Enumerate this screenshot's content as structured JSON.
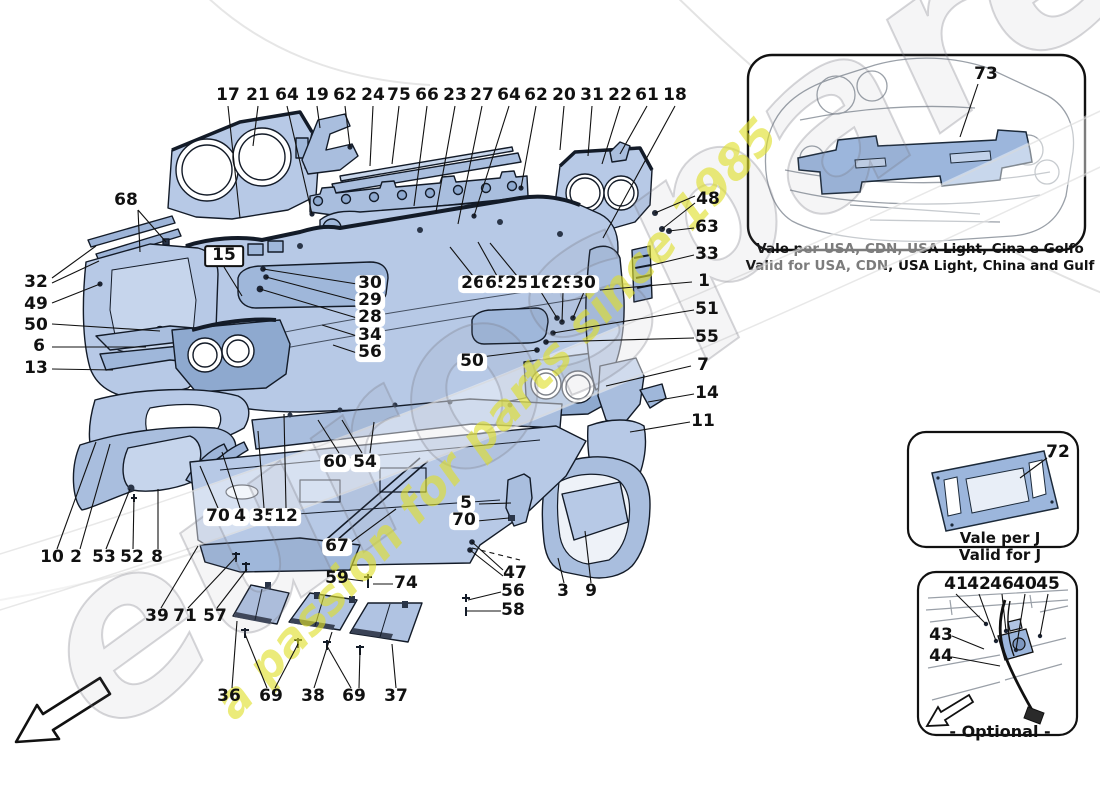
{
  "watermark": {
    "brand": "eurospares",
    "tagline": "a passion for parts since 1985"
  },
  "insets": {
    "usa": {
      "part_label": "73",
      "caption_line1": "Vale per USA, CDN, USA Light, Cina e Golfo",
      "caption_line2": "Valid for USA, CDN, USA Light, China and Gulf"
    },
    "japan": {
      "part_label": "72",
      "caption_line1": "Vale per J",
      "caption_line2": "Valid for J"
    },
    "optional": {
      "caption": "- Optional -"
    }
  },
  "callouts": [
    {
      "t": "17",
      "x": 228,
      "y": 96
    },
    {
      "t": "21",
      "x": 258,
      "y": 96
    },
    {
      "t": "64",
      "x": 287,
      "y": 96
    },
    {
      "t": "19",
      "x": 317,
      "y": 96
    },
    {
      "t": "62",
      "x": 345,
      "y": 96
    },
    {
      "t": "24",
      "x": 373,
      "y": 96
    },
    {
      "t": "75",
      "x": 399,
      "y": 96
    },
    {
      "t": "66",
      "x": 427,
      "y": 96
    },
    {
      "t": "23",
      "x": 455,
      "y": 96
    },
    {
      "t": "27",
      "x": 482,
      "y": 96
    },
    {
      "t": "64",
      "x": 509,
      "y": 96
    },
    {
      "t": "62",
      "x": 536,
      "y": 96
    },
    {
      "t": "20",
      "x": 564,
      "y": 96
    },
    {
      "t": "31",
      "x": 592,
      "y": 96
    },
    {
      "t": "22",
      "x": 620,
      "y": 96
    },
    {
      "t": "61",
      "x": 647,
      "y": 96
    },
    {
      "t": "18",
      "x": 675,
      "y": 96
    },
    {
      "t": "68",
      "x": 126,
      "y": 201
    },
    {
      "t": "32",
      "x": 36,
      "y": 283
    },
    {
      "t": "49",
      "x": 36,
      "y": 305
    },
    {
      "t": "50",
      "x": 36,
      "y": 326
    },
    {
      "t": "6",
      "x": 39,
      "y": 347
    },
    {
      "t": "13",
      "x": 36,
      "y": 369
    },
    {
      "t": "15",
      "x": 224,
      "y": 256,
      "s": 2
    },
    {
      "t": "30",
      "x": 370,
      "y": 284,
      "s": 1
    },
    {
      "t": "29",
      "x": 370,
      "y": 301,
      "s": 1
    },
    {
      "t": "28",
      "x": 370,
      "y": 318,
      "s": 1
    },
    {
      "t": "34",
      "x": 370,
      "y": 336,
      "s": 1
    },
    {
      "t": "56",
      "x": 370,
      "y": 353,
      "s": 1
    },
    {
      "t": "26",
      "x": 473,
      "y": 284,
      "s": 1
    },
    {
      "t": "65",
      "x": 497,
      "y": 284,
      "s": 1
    },
    {
      "t": "25",
      "x": 517,
      "y": 284,
      "s": 1
    },
    {
      "t": "16",
      "x": 541,
      "y": 284,
      "s": 1
    },
    {
      "t": "29",
      "x": 563,
      "y": 284,
      "s": 1
    },
    {
      "t": "30",
      "x": 584,
      "y": 284,
      "s": 1
    },
    {
      "t": "50",
      "x": 472,
      "y": 362,
      "s": 1
    },
    {
      "t": "48",
      "x": 708,
      "y": 200
    },
    {
      "t": "63",
      "x": 707,
      "y": 228
    },
    {
      "t": "33",
      "x": 707,
      "y": 255
    },
    {
      "t": "1",
      "x": 704,
      "y": 282
    },
    {
      "t": "51",
      "x": 707,
      "y": 310
    },
    {
      "t": "55",
      "x": 707,
      "y": 338
    },
    {
      "t": "7",
      "x": 703,
      "y": 366
    },
    {
      "t": "14",
      "x": 707,
      "y": 394
    },
    {
      "t": "11",
      "x": 703,
      "y": 422
    },
    {
      "t": "10",
      "x": 52,
      "y": 558
    },
    {
      "t": "2",
      "x": 76,
      "y": 558
    },
    {
      "t": "53",
      "x": 104,
      "y": 558
    },
    {
      "t": "52",
      "x": 132,
      "y": 558
    },
    {
      "t": "8",
      "x": 157,
      "y": 558
    },
    {
      "t": "39",
      "x": 157,
      "y": 617
    },
    {
      "t": "71",
      "x": 185,
      "y": 617
    },
    {
      "t": "57",
      "x": 215,
      "y": 617
    },
    {
      "t": "36",
      "x": 229,
      "y": 697
    },
    {
      "t": "69",
      "x": 271,
      "y": 697
    },
    {
      "t": "38",
      "x": 313,
      "y": 697
    },
    {
      "t": "69",
      "x": 354,
      "y": 697
    },
    {
      "t": "37",
      "x": 396,
      "y": 697
    },
    {
      "t": "60",
      "x": 335,
      "y": 463,
      "s": 1
    },
    {
      "t": "54",
      "x": 365,
      "y": 463,
      "s": 1
    },
    {
      "t": "70",
      "x": 218,
      "y": 517,
      "s": 1
    },
    {
      "t": "4",
      "x": 240,
      "y": 517,
      "s": 1
    },
    {
      "t": "35",
      "x": 264,
      "y": 517,
      "s": 1
    },
    {
      "t": "12",
      "x": 286,
      "y": 517,
      "s": 1
    },
    {
      "t": "67",
      "x": 337,
      "y": 547,
      "s": 1
    },
    {
      "t": "59",
      "x": 337,
      "y": 579
    },
    {
      "t": "74",
      "x": 406,
      "y": 584
    },
    {
      "t": "5",
      "x": 466,
      "y": 504,
      "s": 1
    },
    {
      "t": "70",
      "x": 464,
      "y": 521,
      "s": 1
    },
    {
      "t": "47",
      "x": 515,
      "y": 574
    },
    {
      "t": "56",
      "x": 513,
      "y": 592
    },
    {
      "t": "58",
      "x": 513,
      "y": 611
    },
    {
      "t": "3",
      "x": 563,
      "y": 592
    },
    {
      "t": "9",
      "x": 591,
      "y": 592
    },
    {
      "t": "73",
      "x": 986,
      "y": 75
    },
    {
      "t": "72",
      "x": 1058,
      "y": 453
    },
    {
      "t": "41",
      "x": 956,
      "y": 585
    },
    {
      "t": "42",
      "x": 979,
      "y": 585
    },
    {
      "t": "46",
      "x": 1002,
      "y": 585
    },
    {
      "t": "40",
      "x": 1025,
      "y": 585
    },
    {
      "t": "45",
      "x": 1048,
      "y": 585
    },
    {
      "t": "43",
      "x": 941,
      "y": 636
    },
    {
      "t": "44",
      "x": 941,
      "y": 657
    }
  ],
  "leaders": [
    [
      228,
      106,
      240,
      218
    ],
    [
      258,
      106,
      253,
      146
    ],
    [
      287,
      106,
      312,
      214
    ],
    [
      317,
      106,
      320,
      128
    ],
    [
      345,
      106,
      350,
      147
    ],
    [
      373,
      106,
      370,
      166
    ],
    [
      399,
      106,
      392,
      164
    ],
    [
      427,
      106,
      414,
      206
    ],
    [
      455,
      106,
      436,
      212
    ],
    [
      482,
      106,
      458,
      224
    ],
    [
      509,
      106,
      474,
      216
    ],
    [
      536,
      106,
      521,
      188
    ],
    [
      564,
      106,
      560,
      150
    ],
    [
      592,
      106,
      588,
      156
    ],
    [
      620,
      106,
      602,
      164
    ],
    [
      647,
      106,
      620,
      154
    ],
    [
      675,
      106,
      603,
      238
    ],
    [
      138,
      210,
      140,
      252
    ],
    [
      138,
      210,
      166,
      242
    ],
    [
      52,
      278,
      96,
      246
    ],
    [
      52,
      283,
      99,
      261
    ],
    [
      52,
      303,
      100,
      284
    ],
    [
      52,
      324,
      160,
      331
    ],
    [
      52,
      347,
      146,
      347
    ],
    [
      52,
      369,
      113,
      370
    ],
    [
      224,
      267,
      242,
      296
    ],
    [
      357,
      284,
      263,
      269
    ],
    [
      357,
      301,
      266,
      277
    ],
    [
      357,
      318,
      260,
      289
    ],
    [
      357,
      336,
      322,
      325
    ],
    [
      357,
      353,
      333,
      345
    ],
    [
      473,
      276,
      450,
      247
    ],
    [
      497,
      276,
      478,
      242
    ],
    [
      517,
      276,
      490,
      243
    ],
    [
      541,
      292,
      557,
      318
    ],
    [
      563,
      292,
      562,
      322
    ],
    [
      584,
      292,
      573,
      318
    ],
    [
      481,
      357,
      537,
      350
    ],
    [
      695,
      196,
      655,
      213
    ],
    [
      695,
      203,
      662,
      229
    ],
    [
      694,
      228,
      669,
      231
    ],
    [
      694,
      255,
      648,
      266
    ],
    [
      692,
      282,
      600,
      290
    ],
    [
      694,
      310,
      553,
      333
    ],
    [
      694,
      338,
      546,
      342
    ],
    [
      691,
      366,
      606,
      386
    ],
    [
      694,
      394,
      648,
      402
    ],
    [
      690,
      422,
      630,
      432
    ],
    [
      57,
      549,
      96,
      442
    ],
    [
      80,
      549,
      110,
      444
    ],
    [
      106,
      549,
      130,
      489
    ],
    [
      133,
      549,
      134,
      497
    ],
    [
      158,
      549,
      158,
      489
    ],
    [
      161,
      608,
      198,
      546
    ],
    [
      188,
      608,
      236,
      557
    ],
    [
      217,
      608,
      247,
      569
    ],
    [
      232,
      688,
      237,
      621
    ],
    [
      267,
      688,
      245,
      634
    ],
    [
      275,
      688,
      298,
      644
    ],
    [
      314,
      688,
      332,
      632
    ],
    [
      351,
      688,
      327,
      646
    ],
    [
      359,
      688,
      360,
      650
    ],
    [
      396,
      688,
      392,
      644
    ],
    [
      339,
      453,
      318,
      420
    ],
    [
      362,
      453,
      342,
      420
    ],
    [
      370,
      453,
      374,
      422
    ],
    [
      218,
      508,
      200,
      466
    ],
    [
      240,
      508,
      222,
      452
    ],
    [
      264,
      508,
      258,
      431
    ],
    [
      286,
      508,
      284,
      414
    ],
    [
      350,
      543,
      396,
      509
    ],
    [
      348,
      579,
      363,
      581
    ],
    [
      393,
      584,
      373,
      584
    ],
    [
      479,
      504,
      511,
      503
    ],
    [
      477,
      521,
      509,
      518
    ],
    [
      503,
      570,
      472,
      542
    ],
    [
      503,
      576,
      470,
      550
    ],
    [
      501,
      592,
      468,
      600
    ],
    [
      501,
      611,
      467,
      611
    ],
    [
      564,
      583,
      558,
      558
    ],
    [
      591,
      583,
      585,
      531
    ],
    [
      978,
      84,
      960,
      137
    ],
    [
      1047,
      458,
      1020,
      478
    ],
    [
      956,
      594,
      986,
      624
    ],
    [
      979,
      594,
      996,
      641
    ],
    [
      1002,
      594,
      1006,
      631
    ],
    [
      1025,
      594,
      1016,
      650
    ],
    [
      1048,
      594,
      1040,
      636
    ],
    [
      952,
      636,
      984,
      649
    ],
    [
      952,
      657,
      1000,
      666
    ],
    [
      472,
      548,
      520,
      560,
      1
    ]
  ]
}
